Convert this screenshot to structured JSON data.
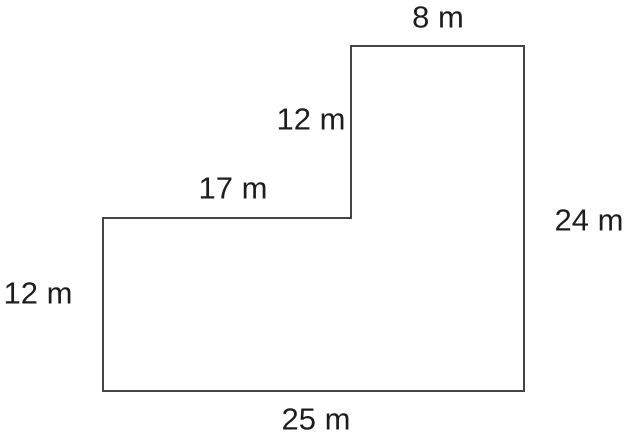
{
  "figure": {
    "type": "composite-l-shaped-polygon",
    "unit": "m",
    "points_string": "351,46 524,46 524,391 103,391 103,218 351,218",
    "stroke_color": "#454545",
    "stroke_width": "2",
    "fill_color": "none",
    "text_color": "#1d1d1d",
    "labels": {
      "top": "8 m",
      "upper_left_vertical": "12 m",
      "middle_horizontal": "17 m",
      "right": "24 m",
      "left": "12 m",
      "bottom": "25 m"
    },
    "dimension_values_m": {
      "top": 8,
      "upper_left_vertical": 12,
      "middle_horizontal": 17,
      "right": 24,
      "left": 12,
      "bottom": 25
    }
  }
}
